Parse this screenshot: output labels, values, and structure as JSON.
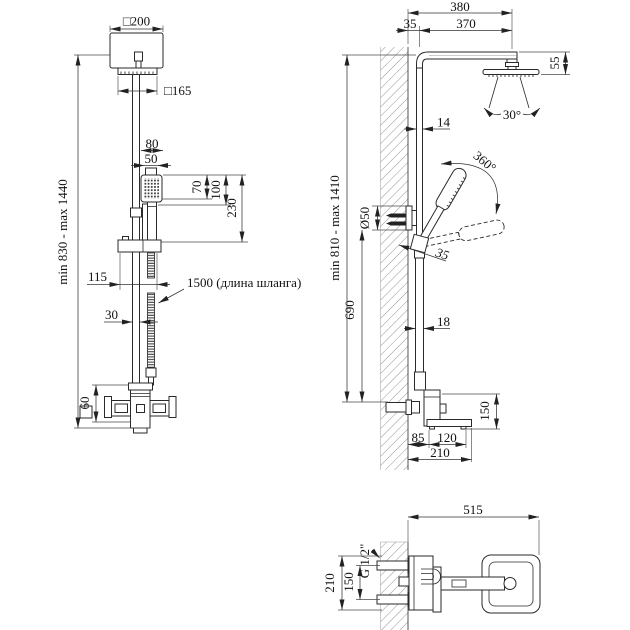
{
  "front": {
    "head_size": "□200",
    "spray_plate_size": "□165",
    "handset_width_outer": "80",
    "handset_width_inner": "50",
    "handset_face_height": "70",
    "handset_head_height": "100",
    "handset_length": "230",
    "holder_width": "115",
    "hose_note": "1500 (длина шланга)",
    "column_width": "30",
    "mixer_height": "60",
    "height_range": "min 830 - max 1440"
  },
  "side": {
    "arm_overall": "380",
    "wall_offset": "35",
    "arm_length": "370",
    "head_drop": "55",
    "spray_angle": "30°",
    "upper_tube": "14",
    "swivel_angle": "360°",
    "holder_diameter": "Ø50",
    "holder_offset": "35",
    "lower_tube": "18",
    "holder_height": "690",
    "height_range": "min 810 - max 1410",
    "spout_drop": "150",
    "wall_to_spout": "85",
    "spout_length": "120",
    "spout_overall": "210"
  },
  "plan": {
    "overall_depth": "515",
    "connection_spacing": "150",
    "body_width": "210",
    "thread": "G 1/2\""
  }
}
